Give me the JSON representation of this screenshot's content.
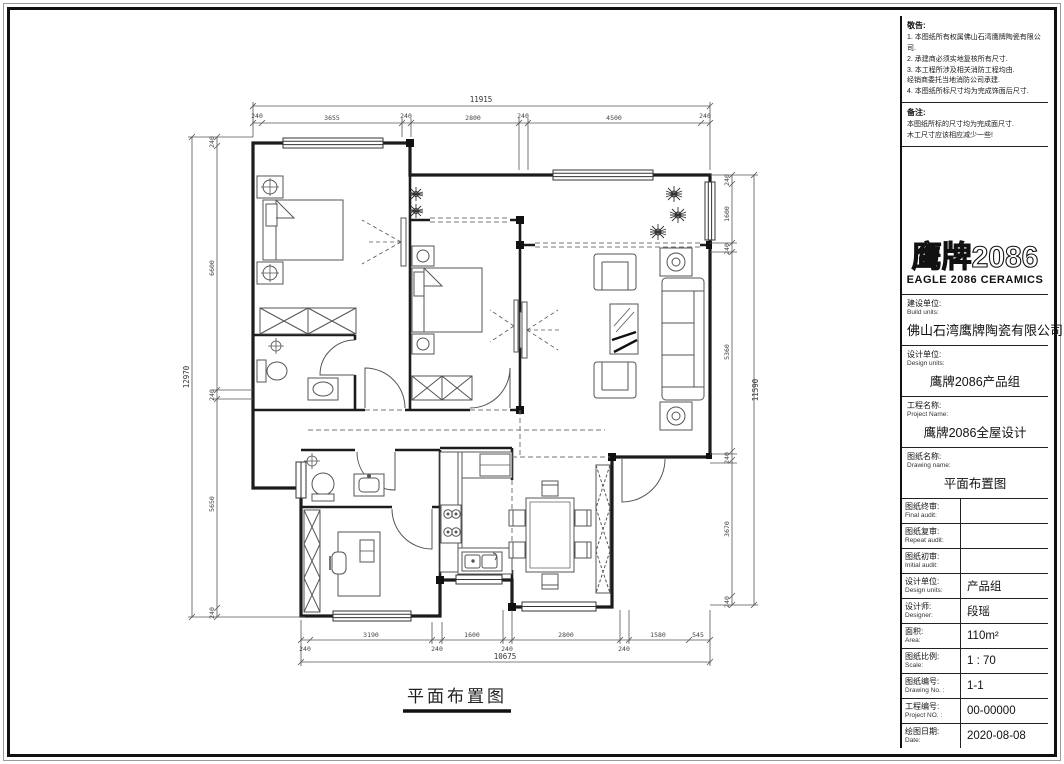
{
  "plan": {
    "caption": "平面布置图",
    "dims": {
      "top": {
        "total": "11915",
        "chain": [
          "240",
          "3655",
          "240",
          "2800",
          "240",
          "4500",
          "240"
        ]
      },
      "bottom": {
        "total": "10675",
        "chain": [
          "240",
          "3190",
          "240",
          "1600",
          "240",
          "2800",
          "240",
          "1580",
          "545"
        ]
      },
      "left": {
        "total": "12970",
        "chain": [
          "240",
          "6600",
          "240",
          "5650",
          "240"
        ]
      },
      "right": {
        "total": "11590",
        "chain": [
          "240",
          "1600",
          "240",
          "5360",
          "240",
          "3670",
          "240"
        ]
      }
    }
  },
  "notice": {
    "title": "敬告:",
    "lines": [
      "1. 本图纸所有权属佛山石湾鹰牌陶瓷有限公司.",
      "2. 承建商必须实地复核所有尺寸.",
      "3. 本工程所涉及相关消防工程均由.",
      "经销商委托当地消防公司承建.",
      "4. 本图纸所标尺寸均为完成饰面后尺寸."
    ]
  },
  "remark": {
    "title": "备注:",
    "lines": [
      "本图纸所标的尺寸均为完成面尺寸.",
      "木工尺寸应该相应减少一些!"
    ]
  },
  "logo": {
    "cn": "鹰牌2086",
    "en": "EAGLE 2086 CERAMICS"
  },
  "titleblock": {
    "full": [
      {
        "cn": "建设单位:",
        "en": "Build units:",
        "value": "佛山石湾鹰牌陶瓷有限公司"
      },
      {
        "cn": "设计单位:",
        "en": "Design units:",
        "value": "鹰牌2086产品组"
      },
      {
        "cn": "工程名称:",
        "en": "Project Name:",
        "value": "鹰牌2086全屋设计"
      },
      {
        "cn": "图纸名称:",
        "en": "Drawing name:",
        "value": "平面布置图"
      }
    ],
    "grid": [
      {
        "cn": "图纸终审:",
        "en": "Final audit:",
        "value": ""
      },
      {
        "cn": "图纸复审:",
        "en": "Repeat audit:",
        "value": ""
      },
      {
        "cn": "图纸初审:",
        "en": "Initial audit:",
        "value": ""
      },
      {
        "cn": "设计单位:",
        "en": "Design units:",
        "value": "产品组"
      },
      {
        "cn": "设计师:",
        "en": "Designer:",
        "value": "段瑶"
      },
      {
        "cn": "面积:",
        "en": "Area:",
        "value": "110m²"
      },
      {
        "cn": "图纸比例:",
        "en": "Scale:",
        "value": "1 : 70"
      },
      {
        "cn": "图纸编号:",
        "en": "Drawing No. :",
        "value": "1-1"
      },
      {
        "cn": "工程编号:",
        "en": "Project NO. :",
        "value": "00-00000"
      },
      {
        "cn": "绘图日期:",
        "en": "Date:",
        "value": "2020-08-08"
      }
    ]
  }
}
